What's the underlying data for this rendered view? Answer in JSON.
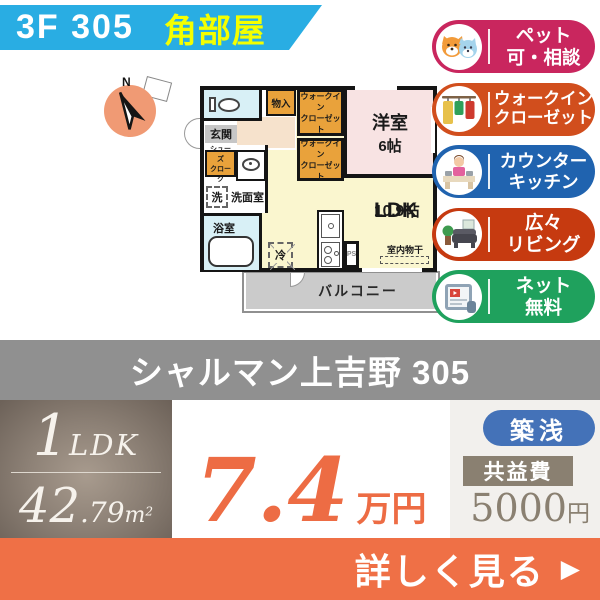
{
  "colors": {
    "banner_blue": "#29ADE3",
    "corner_yellow": "#F4FF00",
    "badge_pets": "#C9265E",
    "badge_wic": "#D14E1D",
    "badge_kitchen": "#2063AF",
    "badge_living": "#C63A10",
    "badge_net": "#1FA15D",
    "name_band_gray": "#909090",
    "price_orange": "#ED6C44",
    "cta_orange": "#EF7046",
    "built_blue": "#4472B8",
    "fee_brown": "#8A8071",
    "plan_closet_orange": "#E9A23B",
    "plan_room_pink": "#F8E3E3",
    "plan_ldk_yellow": "#FAF6CF",
    "plan_wet_blue": "#D8F0F6",
    "plan_balcony_gray": "#CBCBCB"
  },
  "header": {
    "floor_room": "3F 305",
    "corner": "角部屋"
  },
  "badges": [
    {
      "name": "pets-ok",
      "line1": "ペット",
      "line2": "可・相談"
    },
    {
      "name": "walkin-closet",
      "line1": "ウォークイン",
      "line2": "クローゼット"
    },
    {
      "name": "counter-kitchen",
      "line1": "カウンター",
      "line2": "キッチン"
    },
    {
      "name": "spacious-living",
      "line1": "広々",
      "line2": "リビング"
    },
    {
      "name": "free-internet",
      "line1": "ネット",
      "line2": "無料"
    }
  ],
  "floorplan": {
    "compass_n": "N",
    "rooms": {
      "monoire": "物入",
      "wic": "ウォークイン\nクローゼット",
      "youshitsu": "洋室",
      "youshitsu_size": "6帖",
      "genkan": "玄関",
      "shoes": "シューズ\nクローク",
      "wash": "洗",
      "senmen": "洗面室",
      "bath": "浴室",
      "ldk": "LDK",
      "ldk_size": "10.9帖",
      "fridge": "冷",
      "ps": "PS",
      "monohoshi": "室内物干",
      "balcony": "バルコニー"
    }
  },
  "building": {
    "name": "シャルマン上吉野 305"
  },
  "spec": {
    "layout_number": "1",
    "layout_letters": "LDK",
    "area_main": "42",
    "area_decimal": ".79",
    "area_unit": "m",
    "area_sup": "2"
  },
  "price": {
    "value": "7.4",
    "unit": "万円"
  },
  "tags": {
    "built": "築浅"
  },
  "fee": {
    "label": "共益費",
    "value": "5000",
    "unit": "円"
  },
  "cta": {
    "label": "詳しく見る",
    "arrow": "▶"
  }
}
